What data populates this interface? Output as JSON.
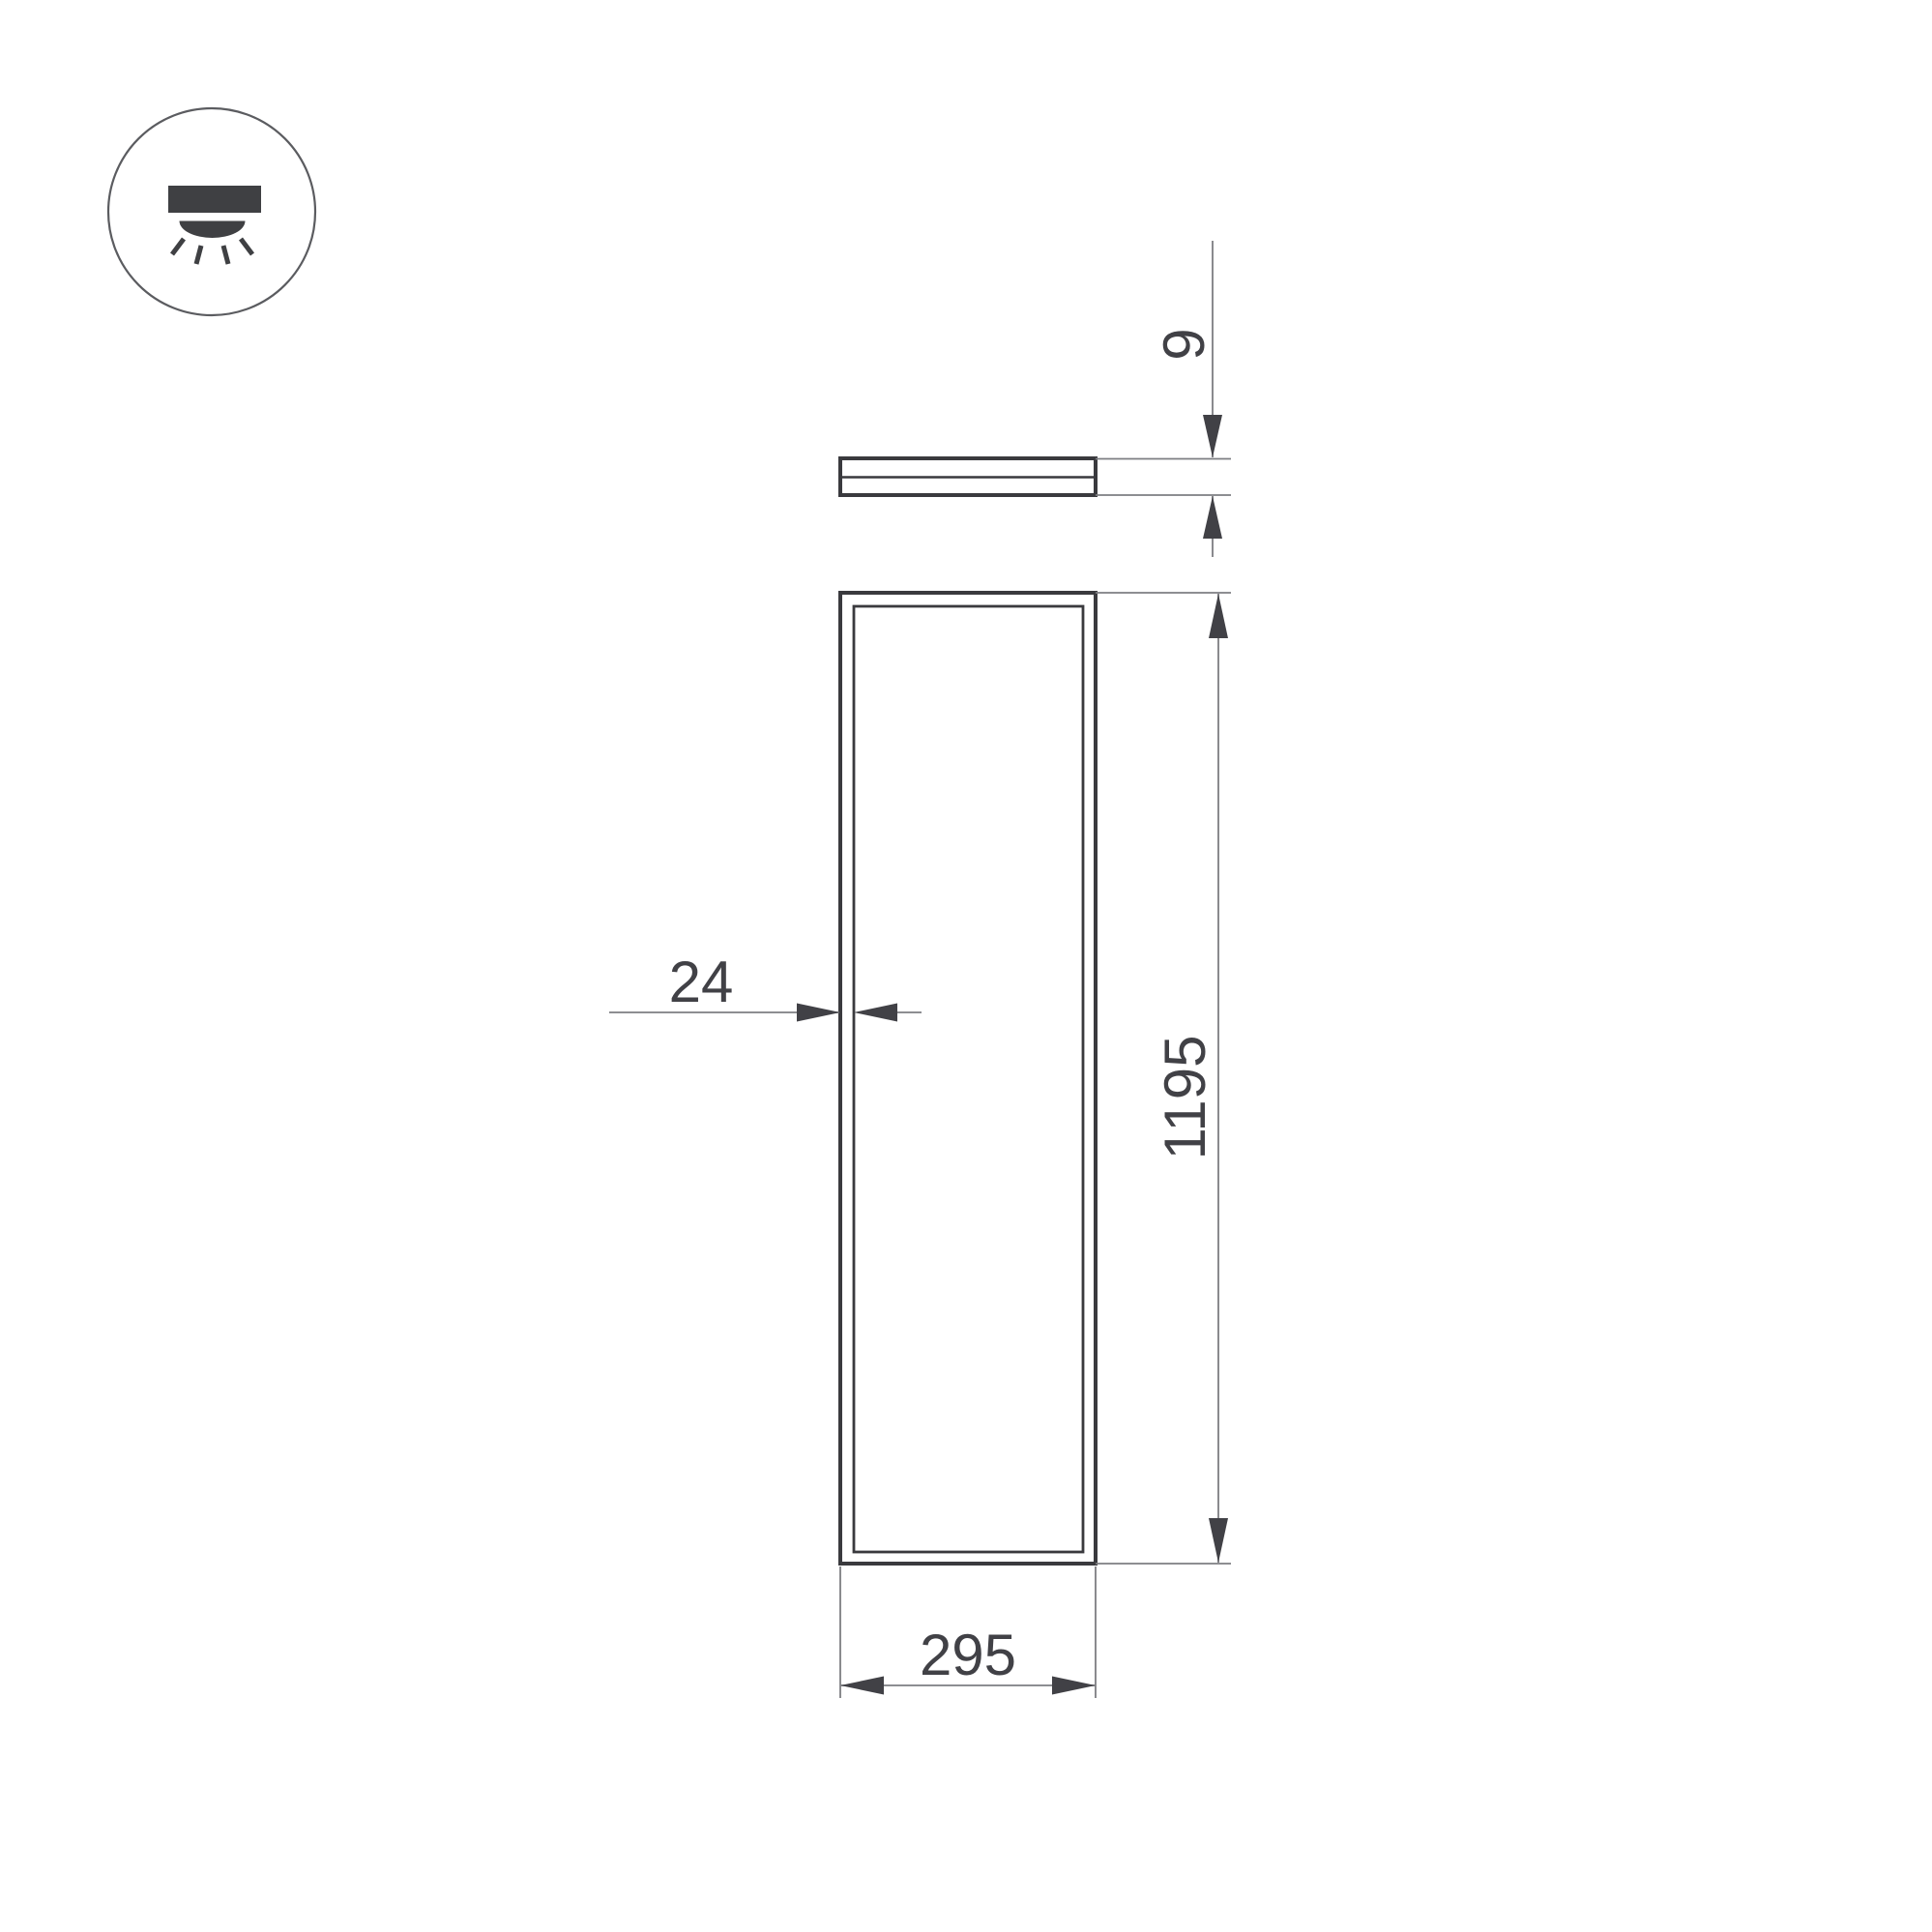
{
  "drawing": {
    "background": "#ffffff",
    "outline_color": "#3a3a3e",
    "dimension_line_color": "#7d7e82",
    "text_color": "#414146",
    "icon": "downlight-icon",
    "dimensions": {
      "side_height": "9",
      "front_height": "1195",
      "front_width": "295",
      "frame_thickness": "24"
    }
  }
}
